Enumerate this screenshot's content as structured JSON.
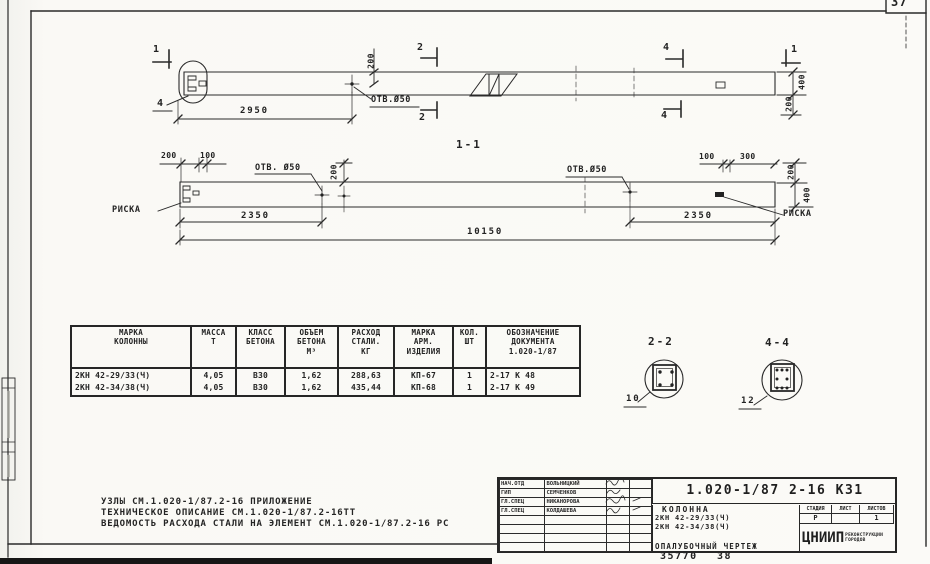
{
  "frame": {
    "corner_number": "37"
  },
  "footer": {
    "num_left": "35770",
    "num_right": "38"
  },
  "plan_view": {
    "marks": {
      "s1_left": "1",
      "s2_top": "2",
      "s2_bottom": "2",
      "s4_top": "4",
      "s4_bottom": "4",
      "s1_right": "1",
      "detail_4": "4"
    },
    "dims": {
      "len_2950": "2950",
      "off_200": "200",
      "end_400": "400",
      "end_200": "200"
    },
    "hole_label": "ОТВ.Ø50"
  },
  "section_view": {
    "title": "1-1",
    "dims": {
      "l200": "200",
      "l100": "100",
      "mid200": "200",
      "r100": "100",
      "r300": "300",
      "r200": "200",
      "r400": "400",
      "left_2350": "2350",
      "right_2350": "2350",
      "total_10150": "10150"
    },
    "hole_label_left": "ОТВ. Ø50",
    "hole_label_right": "ОТВ.Ø50",
    "riska_left": "РИСКА",
    "riska_right": "РИСКА"
  },
  "spec_table": {
    "headers": [
      "МАРКА\nКОЛОННЫ",
      "МАССА\nТ",
      "КЛАСС\nБЕТОНА",
      "ОБЪЕМ\nБЕТОНА\nМ³",
      "РАСХОД\nСТАЛИ.\nКГ",
      "МАРКА\nАРМ.\nИЗДЕЛИЯ",
      "КОЛ.\nШТ",
      "ОБОЗНАЧЕНИЕ\nДОКУМЕНТА\n1.020-1/87"
    ],
    "rows": [
      [
        "2КН 42-29/33(Ч)",
        "4,05",
        "В30",
        "1,62",
        "288,63",
        "КП-67",
        "1",
        "2-17  К 48"
      ],
      [
        "2КН 42-34/38(Ч)",
        "4,05",
        "В30",
        "1,62",
        "435,44",
        "КП-68",
        "1",
        "2-17  К 49"
      ]
    ]
  },
  "details": {
    "s22_title": "2-2",
    "s22_callout": "10",
    "s44_title": "4-4",
    "s44_callout": "12"
  },
  "notes": {
    "line1": "УЗЛЫ СМ.1.020-1/87.2-16 ПРИЛОЖЕНИЕ",
    "line2": "ТЕХНИЧЕСКОЕ ОПИСАНИЕ СМ.1.020-1/87.2-16ТТ",
    "line3": "ВЕДОМОСТЬ РАСХОДА СТАЛИ НА ЭЛЕМЕНТ СМ.1.020-1/87.2-16 РС"
  },
  "title_block": {
    "doc_number": "1.020-1/87 2-16   К31",
    "signatures": [
      {
        "role": "НАЧ.ОТД",
        "name": "ВОЛЬНИЦКИЙ"
      },
      {
        "role": "ГИП",
        "name": "СЕМЧЕНКОВ"
      },
      {
        "role": "ГЛ.СПЕЦ",
        "name": "НИКАНОРОВА"
      },
      {
        "role": "ГЛ.СПЕЦ",
        "name": "КОЛДАШЕВА"
      }
    ],
    "subject_line1": "КОЛОННА",
    "subject_line2": "2КН 42-29/33(Ч)",
    "subject_line3": "2КН 42-34/38(Ч)",
    "subject_line4": "ОПАЛУБОЧНЫЙ ЧЕРТЕЖ",
    "stage_header1": "СТАДИЯ",
    "stage_header2": "ЛИСТ",
    "stage_header3": "ЛИСТОВ",
    "stage_value": "Р",
    "sheets_value": "1",
    "org_abbr": "ЦНИИП",
    "org_line1": "РЕКОНСТРУКЦИИ",
    "org_line2": "ГОРОДОВ"
  }
}
